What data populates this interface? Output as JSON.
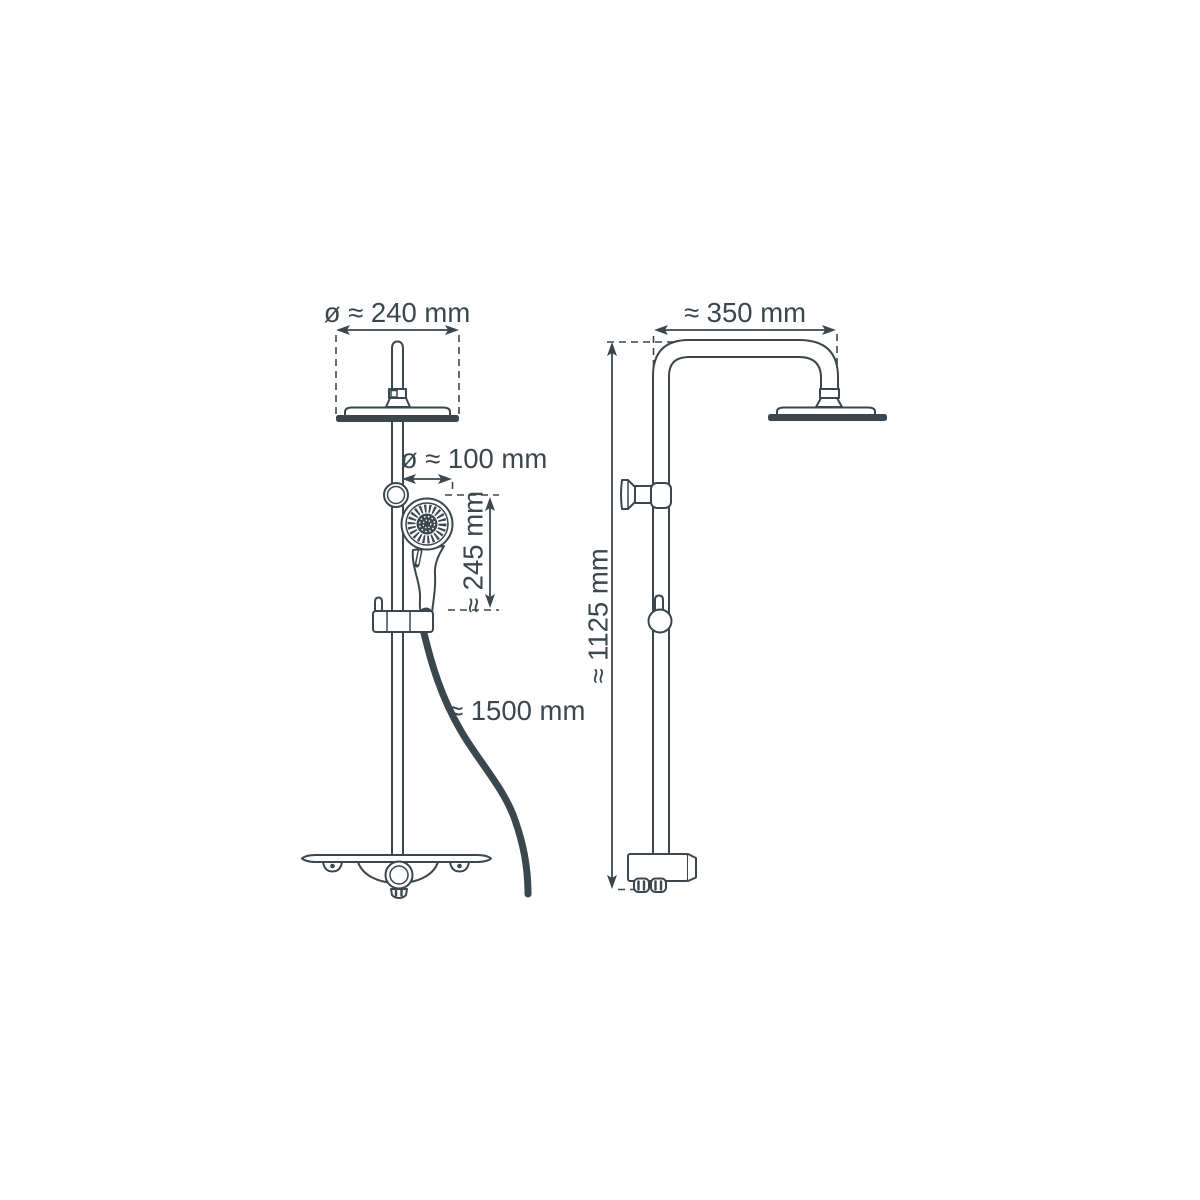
{
  "drawing": {
    "line_color": "#3a474e",
    "background_color": "#ffffff",
    "front_view": {
      "overhead_diameter": "ø ≈ 240 mm",
      "hand_diameter": "ø ≈ 100 mm",
      "hand_length": "≈ 245 mm",
      "hose_length": "≈ 1500 mm"
    },
    "side_view": {
      "arm_reach": "≈ 350 mm",
      "total_height": "≈ 1125 mm"
    }
  }
}
